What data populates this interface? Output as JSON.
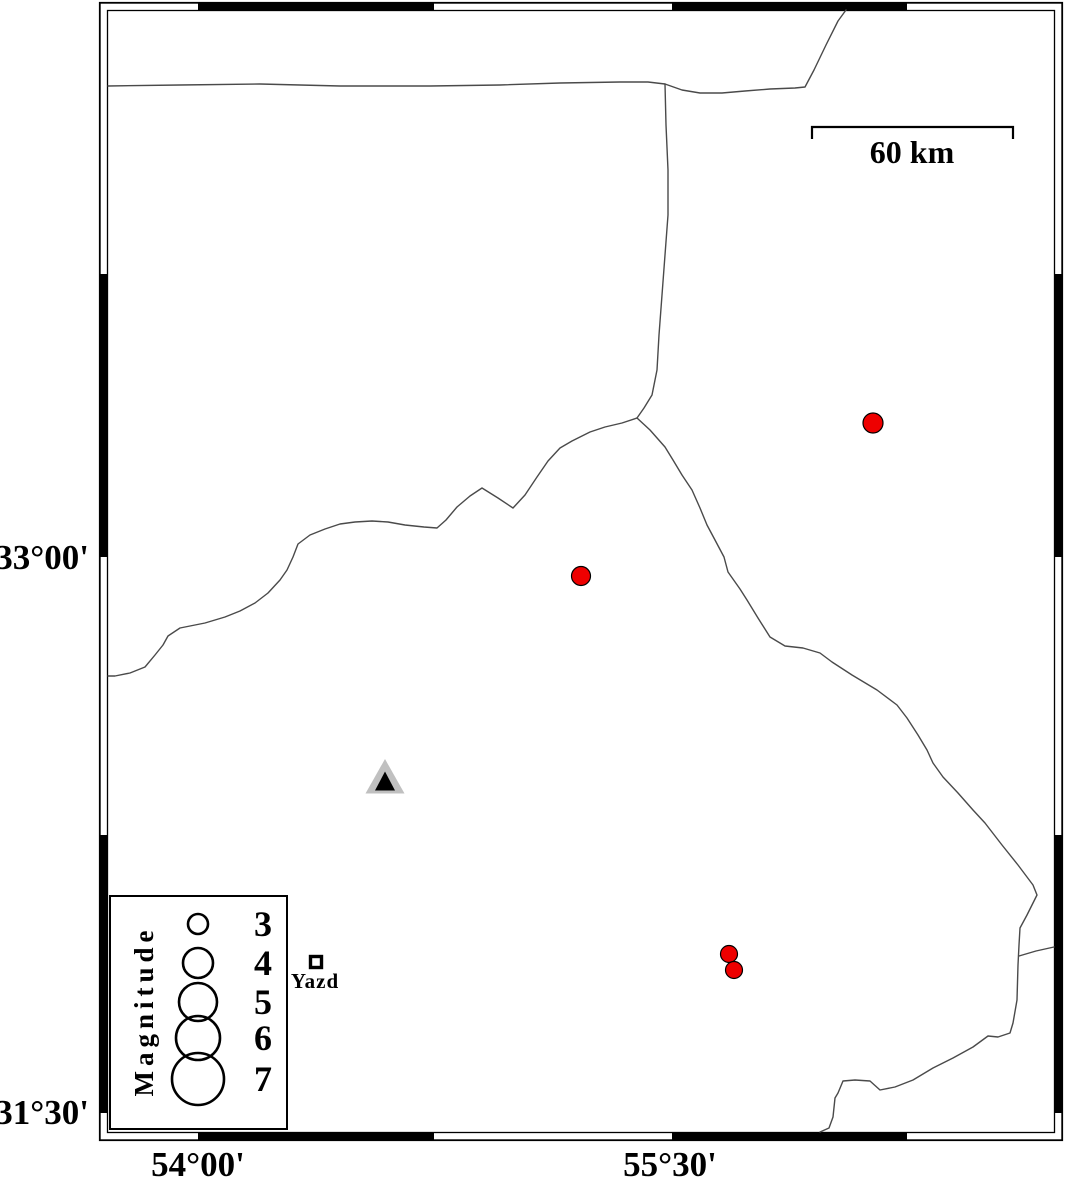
{
  "figure": {
    "scale_bar": {
      "label": "60 km"
    },
    "axis_labels": {
      "left_top": "33°00'",
      "left_bottom": "31°30'",
      "bottom_left": "54°00'",
      "bottom_right": "55°30'"
    },
    "city": {
      "name": "Yazd",
      "x": 316,
      "y": 962
    },
    "station": {
      "x": 385,
      "y": 777
    },
    "earthquakes": [
      {
        "x": 873,
        "y": 423,
        "r": 10
      },
      {
        "x": 581,
        "y": 576,
        "r": 9.5
      },
      {
        "x": 729,
        "y": 954,
        "r": 8.5
      },
      {
        "x": 734,
        "y": 970,
        "r": 8.5
      }
    ],
    "legend": {
      "title": "Magnitude",
      "items": [
        {
          "label": "3",
          "cy": 924,
          "r": 10
        },
        {
          "label": "4",
          "cy": 963,
          "r": 15
        },
        {
          "label": "5",
          "cy": 1002,
          "r": 19
        },
        {
          "label": "6",
          "cy": 1038,
          "r": 22
        },
        {
          "label": "7",
          "cy": 1079,
          "r": 26
        }
      ]
    },
    "colors": {
      "epicenter_fill": "#ee0000",
      "marker_stroke": "#000000",
      "station_outer": "#c0c0c0",
      "station_inner": "#000000",
      "boundary_line": "#4a4a4a"
    },
    "frame": {
      "black_x_spans": [
        [
          198,
          434
        ],
        [
          672,
          907
        ]
      ],
      "black_y_spans": [
        [
          274,
          557
        ],
        [
          835,
          1113
        ]
      ]
    },
    "map_lines": [
      {
        "name": "northern-road",
        "points": [
          [
            108,
            86
          ],
          [
            180,
            85
          ],
          [
            260,
            84
          ],
          [
            340,
            86
          ],
          [
            430,
            86
          ],
          [
            500,
            85
          ],
          [
            560,
            83
          ],
          [
            620,
            82
          ],
          [
            648,
            82
          ],
          [
            665,
            84
          ],
          [
            682,
            90
          ],
          [
            700,
            93
          ],
          [
            722,
            93
          ],
          [
            745,
            91
          ],
          [
            770,
            89
          ],
          [
            795,
            88
          ],
          [
            805,
            87
          ],
          [
            814,
            70
          ],
          [
            826,
            45
          ],
          [
            838,
            21
          ],
          [
            846,
            10
          ]
        ]
      },
      {
        "name": "north-boundary",
        "points": [
          [
            665,
            84
          ],
          [
            666,
            125
          ],
          [
            668,
            170
          ],
          [
            668,
            215
          ],
          [
            665,
            255
          ],
          [
            662,
            295
          ],
          [
            659,
            335
          ],
          [
            657,
            370
          ],
          [
            652,
            395
          ],
          [
            644,
            408
          ],
          [
            637,
            418
          ]
        ]
      },
      {
        "name": "west-boundary",
        "points": [
          [
            637,
            418
          ],
          [
            622,
            423
          ],
          [
            605,
            427
          ],
          [
            590,
            432
          ],
          [
            572,
            441
          ],
          [
            560,
            448
          ],
          [
            548,
            461
          ],
          [
            537,
            477
          ],
          [
            525,
            495
          ],
          [
            513,
            508
          ],
          [
            498,
            498
          ],
          [
            482,
            488
          ],
          [
            470,
            496
          ],
          [
            457,
            507
          ],
          [
            446,
            520
          ],
          [
            437,
            528
          ],
          [
            424,
            527
          ],
          [
            405,
            525
          ],
          [
            388,
            522
          ],
          [
            372,
            521
          ],
          [
            355,
            522
          ],
          [
            340,
            524
          ],
          [
            325,
            529
          ],
          [
            310,
            535
          ],
          [
            298,
            544
          ],
          [
            293,
            557
          ],
          [
            287,
            570
          ],
          [
            280,
            580
          ],
          [
            268,
            593
          ],
          [
            255,
            603
          ],
          [
            240,
            611
          ],
          [
            225,
            617
          ],
          [
            205,
            623
          ],
          [
            180,
            628
          ],
          [
            168,
            636
          ],
          [
            163,
            645
          ],
          [
            155,
            655
          ],
          [
            145,
            667
          ],
          [
            130,
            673
          ],
          [
            115,
            676
          ],
          [
            108,
            676
          ]
        ]
      },
      {
        "name": "southeast-boundary",
        "points": [
          [
            637,
            418
          ],
          [
            650,
            430
          ],
          [
            665,
            447
          ],
          [
            673,
            460
          ],
          [
            682,
            475
          ],
          [
            692,
            490
          ],
          [
            700,
            508
          ],
          [
            707,
            525
          ],
          [
            715,
            540
          ],
          [
            724,
            557
          ],
          [
            728,
            572
          ],
          [
            740,
            589
          ],
          [
            747,
            600
          ],
          [
            758,
            618
          ],
          [
            770,
            637
          ],
          [
            785,
            646
          ],
          [
            803,
            648
          ],
          [
            820,
            653
          ],
          [
            832,
            662
          ],
          [
            852,
            675
          ],
          [
            877,
            690
          ],
          [
            897,
            705
          ],
          [
            907,
            718
          ],
          [
            918,
            735
          ],
          [
            927,
            750
          ],
          [
            933,
            763
          ],
          [
            943,
            777
          ],
          [
            958,
            793
          ],
          [
            973,
            810
          ],
          [
            985,
            823
          ],
          [
            1002,
            845
          ],
          [
            1018,
            865
          ],
          [
            1033,
            885
          ],
          [
            1037,
            895
          ],
          [
            1027,
            915
          ],
          [
            1020,
            928
          ],
          [
            1019,
            945
          ],
          [
            1018,
            965
          ],
          [
            1017,
            1000
          ],
          [
            1013,
            1023
          ],
          [
            1010,
            1033
          ],
          [
            998,
            1037
          ],
          [
            988,
            1036
          ],
          [
            973,
            1047
          ],
          [
            953,
            1058
          ],
          [
            933,
            1068
          ],
          [
            913,
            1080
          ],
          [
            895,
            1087
          ],
          [
            880,
            1090
          ],
          [
            870,
            1081
          ],
          [
            855,
            1080
          ],
          [
            843,
            1081
          ],
          [
            838,
            1093
          ],
          [
            835,
            1098
          ],
          [
            833,
            1117
          ],
          [
            829,
            1128
          ],
          [
            820,
            1132
          ]
        ]
      },
      {
        "name": "east-connector",
        "points": [
          [
            1054,
            947
          ],
          [
            1036,
            951
          ],
          [
            1019,
            956
          ]
        ]
      }
    ]
  }
}
